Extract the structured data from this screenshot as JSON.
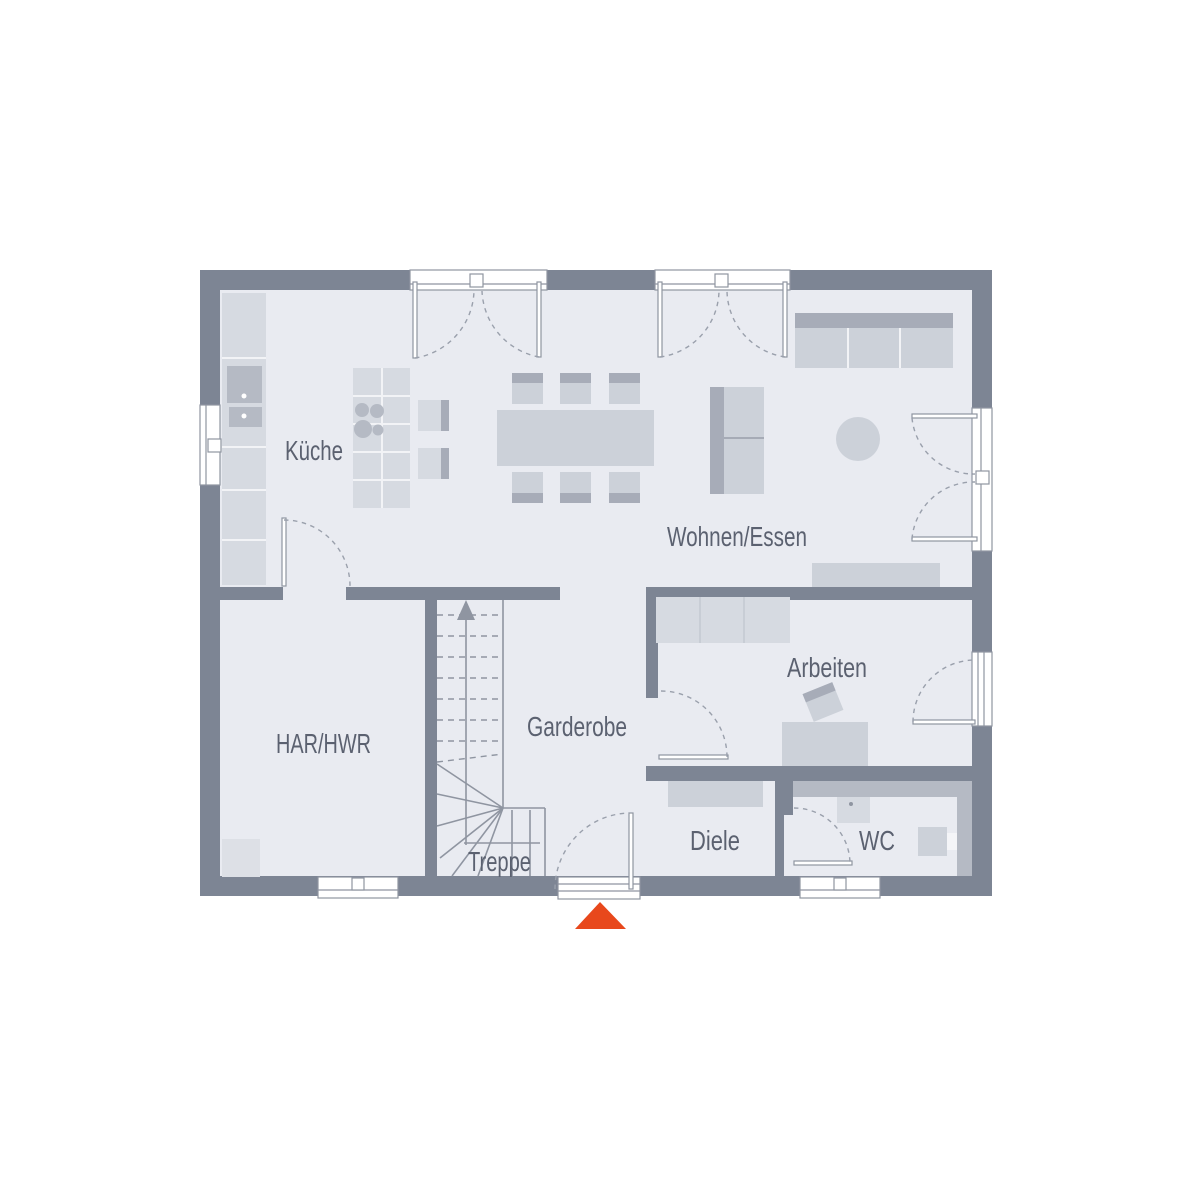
{
  "rooms": [
    {
      "id": "kueche",
      "label": "Küche"
    },
    {
      "id": "wohnen-essen",
      "label": "Wohnen/Essen"
    },
    {
      "id": "har-hwr",
      "label": "HAR/HWR"
    },
    {
      "id": "garderobe",
      "label": "Garderobe"
    },
    {
      "id": "treppe",
      "label": "Treppe"
    },
    {
      "id": "arbeiten",
      "label": "Arbeiten"
    },
    {
      "id": "diele",
      "label": "Diele"
    },
    {
      "id": "wc",
      "label": "WC"
    }
  ],
  "icons": [
    {
      "name": "entrance-marker-icon",
      "meaning": "main entrance direction triangle"
    },
    {
      "name": "stair-direction-arrow-icon",
      "meaning": "stairs going up"
    }
  ],
  "colors": {
    "wall": "#7d8594",
    "floor": "#e9ebf1",
    "furniture": "#ccd1d9",
    "furniture_dark": "#a7acb8",
    "label_text": "#5b6170",
    "entrance_marker": "#e8481c"
  }
}
